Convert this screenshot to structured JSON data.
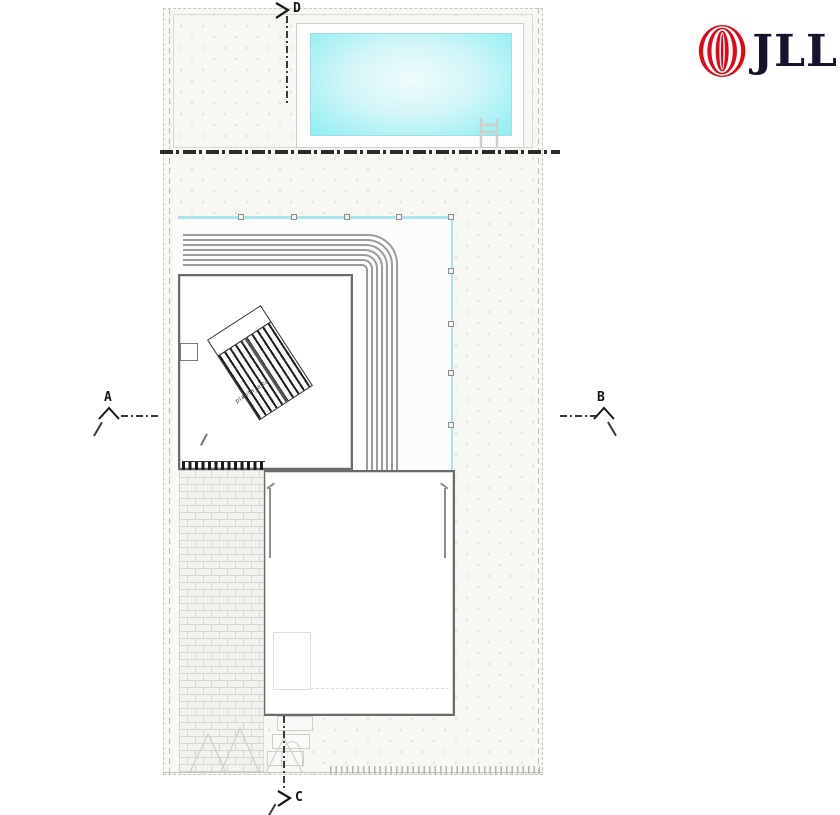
{
  "logo": {
    "text": "JLL",
    "mark_color": "#e30613",
    "text_color": "#16132d"
  },
  "markers": {
    "a": "A",
    "b": "B",
    "c": "C",
    "d": "D"
  },
  "stairs": {
    "label": "planta_alta"
  },
  "colors": {
    "pool_edge": "#8feef3",
    "pool_center": "#f0fcfc",
    "railing": "#a9e5ee",
    "steps_line": "#9c9c9c",
    "wall": "#6b6b6b",
    "background_dot": "#e0ebd4",
    "heavy_section_line": "#2b2b2b",
    "brick_line": "#d7d7d1",
    "logo_red": "#e30613"
  }
}
